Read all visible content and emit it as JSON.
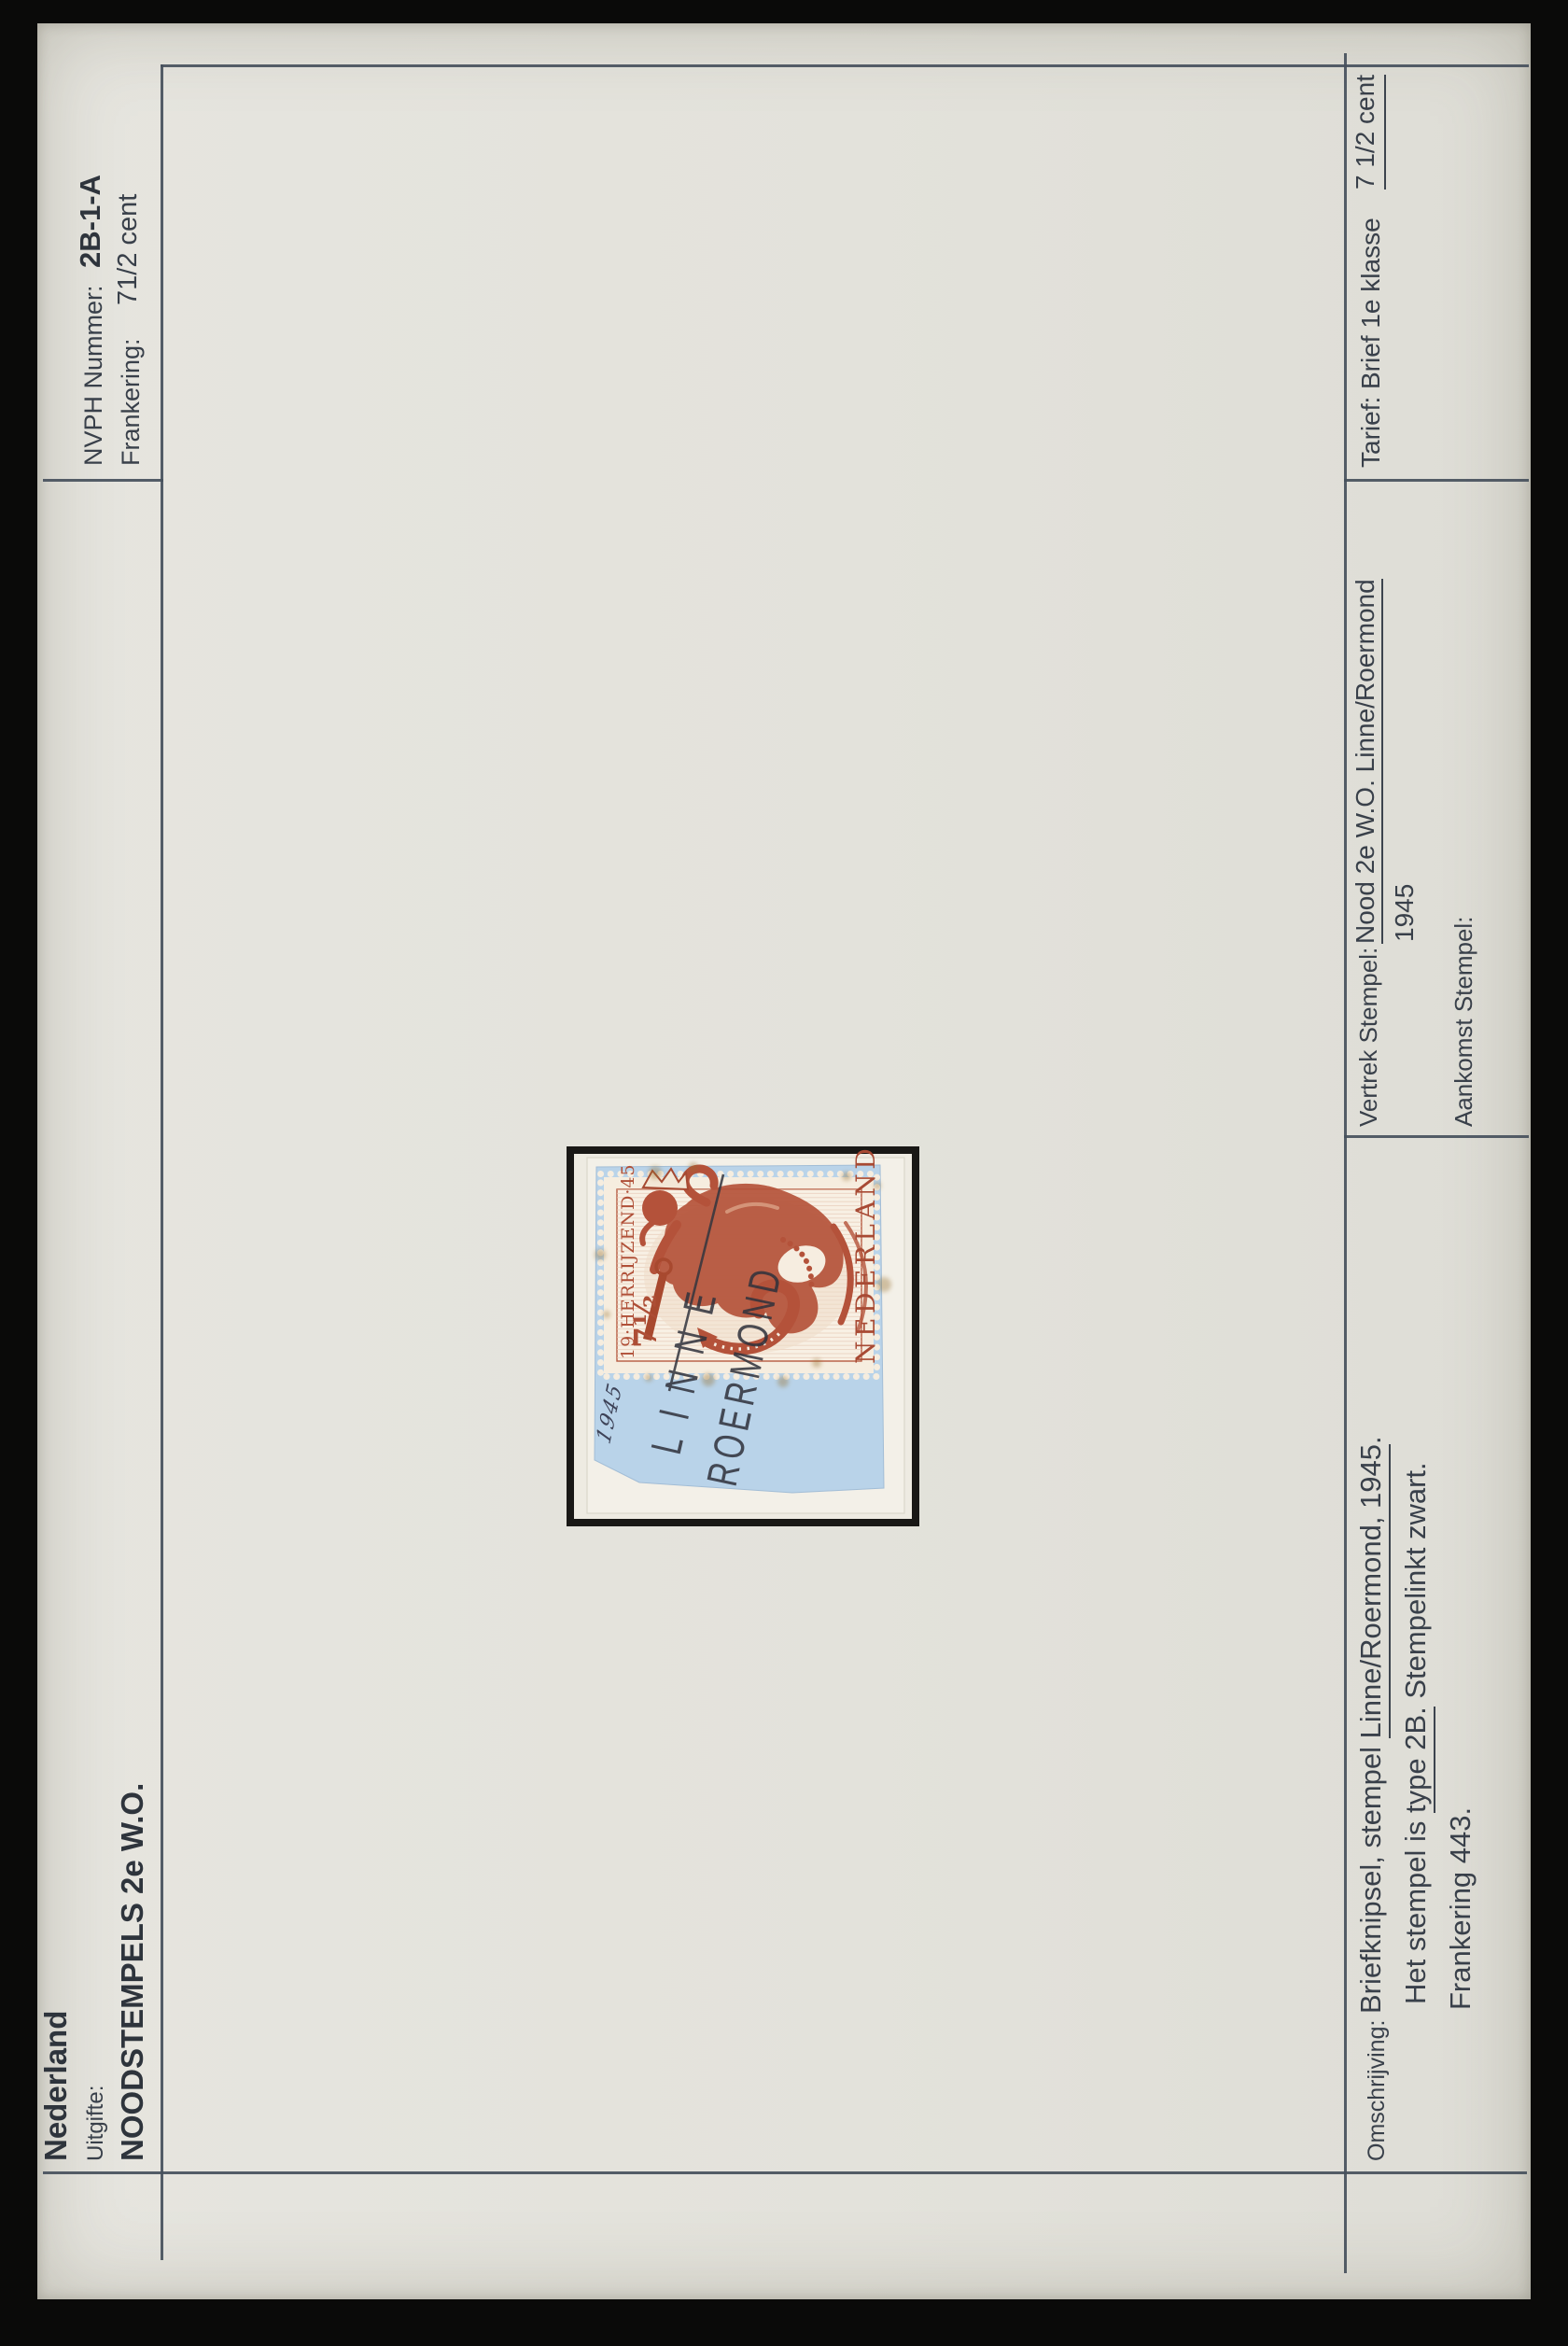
{
  "header": {
    "country": "Nederland",
    "uitgifte_label": "Uitgifte:",
    "series_title": "NOODSTEMPELS 2e W.O.",
    "nvph_label": "NVPH Nummer:",
    "nvph_value": "2B-1-A",
    "frankering_label": "Frankering:",
    "frankering_value": "71/2 cent"
  },
  "stamp": {
    "top_inscription": "19·HERRIJZEND·45",
    "face_value": "7½",
    "country": "NEDERLAND",
    "postmark_line1": "LINNE",
    "postmark_line2": "ROERMOND",
    "handwritten_year": "1945"
  },
  "details": {
    "vertrek_label": "Vertrek Stempel:",
    "vertrek_value": "Nood 2e W.O. Linne/Roermond",
    "vertrek_year": "1945",
    "aankomst_label": "Aankomst Stempel:",
    "tarief_label": "Tarief:",
    "tarief_value": "Brief 1e klasse",
    "rate_note": "7 1/2 cent"
  },
  "description": {
    "label": "Omschrijving:",
    "line1_a": "Briefknipsel, stempel ",
    "line1_b": "Linne/Roermond, 1945",
    "line1_c": ".",
    "line2_a": "Het stempel is ",
    "line2_b": "type 2B.",
    "line2_c": " Stempelinkt zwart.",
    "line3": "Frankering 443."
  },
  "colors": {
    "page_cream": "#e3e2db",
    "surround_black": "#0a0a09",
    "rule_line": "#47505c",
    "text_dark": "#39404a",
    "stamp_red": "#b4523a",
    "clipping_blue": "#b9d3e9",
    "postmark_ink": "#30323c",
    "mount_frame": "#191816"
  }
}
